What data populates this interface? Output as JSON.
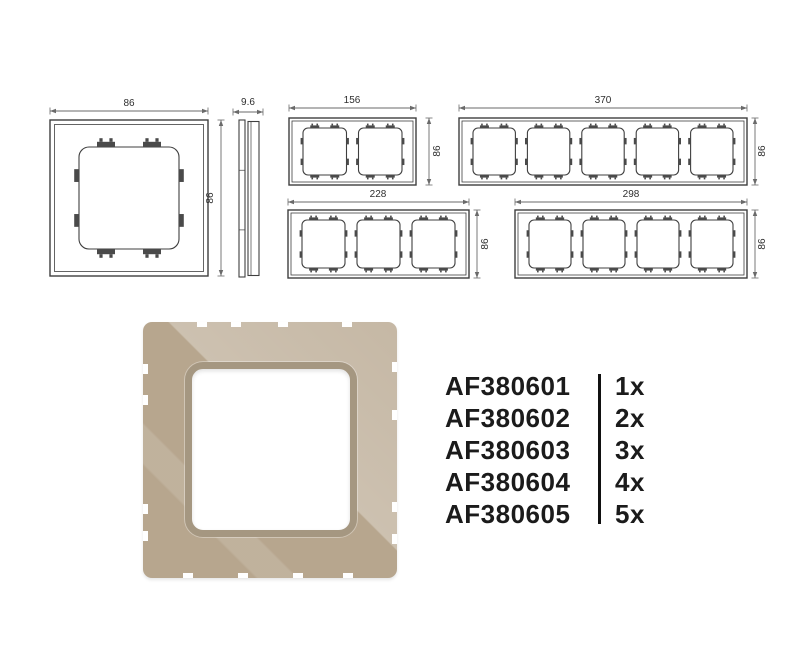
{
  "meta": {
    "background": "#ffffff",
    "line_color": "#3f3f3f",
    "thin_line_color": "#6a6a6a",
    "clip_color": "#4a4a4a",
    "dim_text_color": "#2e2e2e"
  },
  "drawings": {
    "frames": [
      {
        "name": "drawing-1gang-front",
        "x": 50,
        "y": 120,
        "w": 158,
        "h": 156,
        "gangs": 1,
        "inset": 4.5,
        "sm": 29,
        "tm": 27,
        "gap": 0,
        "r": 10,
        "clip": 2,
        "dims": [
          {
            "type": "h",
            "x1": 50,
            "x2": 208,
            "y": 111,
            "label": "86",
            "lx": 129,
            "ly": 106
          },
          {
            "type": "v",
            "x": 221,
            "y1": 120,
            "y2": 276,
            "label": "86",
            "lx": 213,
            "ly": 198
          }
        ]
      },
      {
        "name": "drawing-side-profile",
        "side": true,
        "x": 239,
        "y": 120,
        "w": 20,
        "h": 157,
        "dims": [
          {
            "type": "h",
            "x1": 233,
            "x2": 263,
            "y": 112,
            "label": "9.6",
            "lx": 248,
            "ly": 105
          }
        ]
      },
      {
        "name": "drawing-2gang-front",
        "x": 289,
        "y": 118,
        "w": 127,
        "h": 67,
        "gangs": 2,
        "inset": 3,
        "sm": 14,
        "tm": 10,
        "gap": 12,
        "r": 5,
        "clip": 1,
        "dims": [
          {
            "type": "h",
            "x1": 289,
            "x2": 416,
            "y": 108,
            "label": "156",
            "lx": 352,
            "ly": 103
          },
          {
            "type": "v",
            "x": 429,
            "y1": 118,
            "y2": 185,
            "label": "86",
            "lx": 440,
            "ly": 151
          }
        ]
      },
      {
        "name": "drawing-5gang-front",
        "x": 459,
        "y": 118,
        "w": 288,
        "h": 67,
        "gangs": 5,
        "inset": 3,
        "sm": 14,
        "tm": 10,
        "gap": 12,
        "r": 5,
        "clip": 1,
        "dims": [
          {
            "type": "h",
            "x1": 459,
            "x2": 747,
            "y": 108,
            "label": "370",
            "lx": 603,
            "ly": 103
          },
          {
            "type": "v",
            "x": 755,
            "y1": 118,
            "y2": 185,
            "label": "86",
            "lx": 765,
            "ly": 151
          }
        ]
      },
      {
        "name": "drawing-3gang-front",
        "x": 288,
        "y": 210,
        "w": 181,
        "h": 68,
        "gangs": 3,
        "inset": 3,
        "sm": 14,
        "tm": 10,
        "gap": 12,
        "r": 5,
        "clip": 1,
        "dims": [
          {
            "type": "h",
            "x1": 288,
            "x2": 469,
            "y": 202,
            "label": "228",
            "lx": 378,
            "ly": 197
          },
          {
            "type": "v",
            "x": 477,
            "y1": 210,
            "y2": 278,
            "label": "86",
            "lx": 488,
            "ly": 244
          }
        ]
      },
      {
        "name": "drawing-4gang-front",
        "x": 515,
        "y": 210,
        "w": 232,
        "h": 68,
        "gangs": 4,
        "inset": 3,
        "sm": 14,
        "tm": 10,
        "gap": 12,
        "r": 5,
        "clip": 1,
        "dims": [
          {
            "type": "h",
            "x1": 515,
            "x2": 747,
            "y": 202,
            "label": "298",
            "lx": 631,
            "ly": 197
          },
          {
            "type": "v",
            "x": 755,
            "y1": 210,
            "y2": 278,
            "label": "86",
            "lx": 765,
            "ly": 244
          }
        ]
      }
    ]
  },
  "photo": {
    "description": "1-gang beige glass cover frame",
    "base_color": "#b7a68e",
    "highlight_color": "#cdbfa8",
    "ring_color": "#a59781",
    "opening_color": "#ffffff",
    "notches": {
      "top": [
        54,
        88,
        135,
        199
      ],
      "bottom": [
        40,
        95,
        150,
        200
      ],
      "left": [
        42,
        73,
        182,
        209
      ],
      "right": [
        40,
        88,
        180,
        212
      ]
    }
  },
  "codes": {
    "items": [
      {
        "code": "AF380601",
        "qty": "1x"
      },
      {
        "code": "AF380602",
        "qty": "2x"
      },
      {
        "code": "AF380603",
        "qty": "3x"
      },
      {
        "code": "AF380604",
        "qty": "4x"
      },
      {
        "code": "AF380605",
        "qty": "5x"
      }
    ]
  }
}
